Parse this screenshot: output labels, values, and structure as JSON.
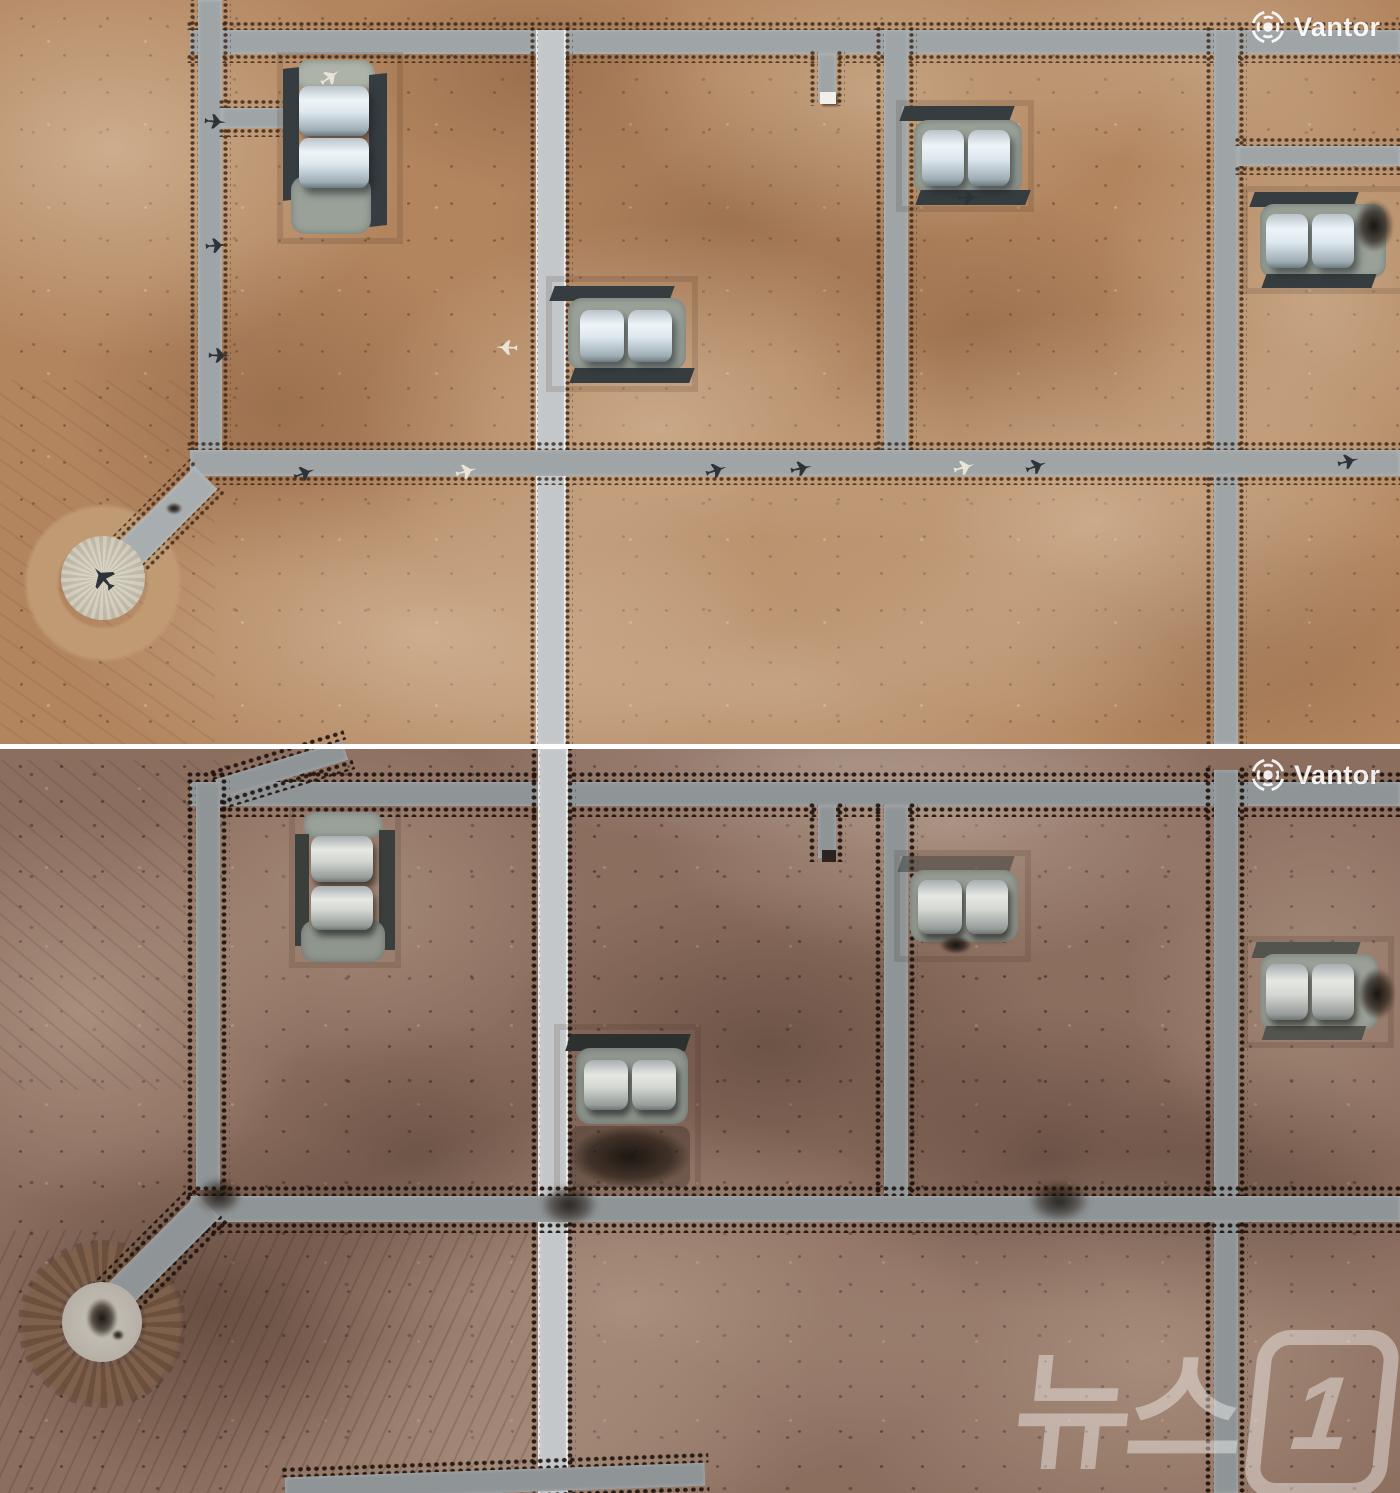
{
  "watermarks": {
    "provider": "Vantor",
    "news_text": "뉴스",
    "news_suffix": "1"
  },
  "palette": {
    "ground_top": "#b2855f",
    "ground_top_light": "#ddc5a6",
    "ground_top_dark": "#5a3f28",
    "ground_bottom": "#8c6e5f",
    "ground_bottom_light": "#b59c8b",
    "ground_bottom_dark": "#46332a",
    "road": "#9fa4a6",
    "road_bright": "#c3c7c9",
    "road_dim": "#8f9496",
    "apron": "#99a198",
    "wall": "#363d40",
    "shelter_top": "#edf4f8",
    "shelter_bottom": "#d9dcd8",
    "pad_top": "#d8d2c1",
    "pad_bottom": "#c9c4bc",
    "berm_top": "#c09a73",
    "berm_bottom": "#7e604b",
    "burn": "#241c16",
    "divider": "#ffffff",
    "watermark": "#ffffff"
  }
}
